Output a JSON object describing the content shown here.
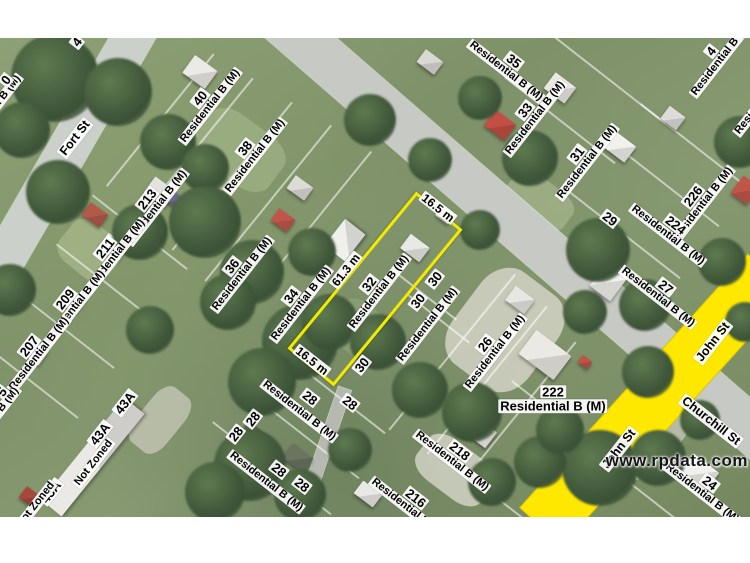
{
  "branding": {
    "watermark": "www.rpdata.com"
  },
  "colors": {
    "highlight_parcel": "#f2ea00",
    "highlighted_street": "#ffe800",
    "label_bg": "#ffffff",
    "label_text": "#000000",
    "road_gray": "#c7c9c4"
  },
  "streets": [
    {
      "name": "Fort St"
    },
    {
      "name": "John St"
    },
    {
      "name": "John St"
    },
    {
      "name": "Churchill St"
    }
  ],
  "highlighted_parcel": {
    "number": "32",
    "zone": "Residential B (M)",
    "frontage": "16.5 m",
    "depth": "61.3 m",
    "rear": "16.5 m"
  },
  "dimensions": [
    {
      "text": "16.5 m"
    },
    {
      "text": "61.3 m"
    },
    {
      "text": "16.5 m"
    }
  ],
  "parcels": [
    {
      "number": "40",
      "zone": "Residential B (M)"
    },
    {
      "number": "38",
      "zone": "Residential B (M)"
    },
    {
      "number": "36",
      "zone": "Residential B (M)"
    },
    {
      "number": "34",
      "zone": "Residential B (M)"
    },
    {
      "number": "32",
      "zone": "Residential B (M)"
    },
    {
      "number": "213",
      "zone": "Residential B (M)"
    },
    {
      "number": "211",
      "zone": "Residential B (M)"
    },
    {
      "number": "209",
      "zone": "Residential B (M)"
    },
    {
      "number": "207",
      "zone": "Residential B (M)"
    },
    {
      "number": "35",
      "zone": "Residential B (M)"
    },
    {
      "number": "33",
      "zone": "Residential B (M)"
    },
    {
      "number": "31",
      "zone": "Residential B (M)"
    },
    {
      "number": "29",
      "zone": ""
    },
    {
      "number": "226",
      "zone": "Residential B (M)"
    },
    {
      "number": "224",
      "zone": "Residential B (M)"
    },
    {
      "number": "27",
      "zone": "Residential B (M)"
    },
    {
      "number": "26",
      "zone": "Residential B (M)"
    },
    {
      "number": "222",
      "zone": "Residential B (M)"
    },
    {
      "number": "218",
      "zone": "Residential B (M)"
    },
    {
      "number": "216",
      "zone": "Residential B (M)"
    },
    {
      "number": "24",
      "zone": "Residential B (M)"
    },
    {
      "number": "30",
      "zone": ""
    },
    {
      "number": "30",
      "zone": ""
    },
    {
      "number": "",
      "zone": "Residential B (M)"
    },
    {
      "number": "30",
      "zone": ""
    },
    {
      "number": "28",
      "zone": ""
    },
    {
      "number": "28",
      "zone": ""
    },
    {
      "number": "",
      "zone": "Residential B (M)"
    },
    {
      "number": "28",
      "zone": ""
    },
    {
      "number": "28",
      "zone": ""
    },
    {
      "number": "28",
      "zone": ""
    },
    {
      "number": "28",
      "zone": ""
    },
    {
      "number": "",
      "zone": "Residential B (M)"
    },
    {
      "number": "43A",
      "zone": ""
    },
    {
      "number": "43A",
      "zone": ""
    },
    {
      "number": "",
      "zone": "Not Zoned"
    },
    {
      "number": "43A",
      "zone": ""
    },
    {
      "number": "",
      "zone": "Not Zoned"
    }
  ],
  "partial_labels": [
    {
      "number": "4",
      "zone": "Residential B (M)"
    },
    {
      "number": "",
      "zone": "Residential B (M)"
    },
    {
      "number": "0",
      "zone": "Residential B (M)"
    },
    {
      "number": "5",
      "zone": "Residential B (M)"
    },
    {
      "number": "4",
      "zone": ""
    }
  ]
}
